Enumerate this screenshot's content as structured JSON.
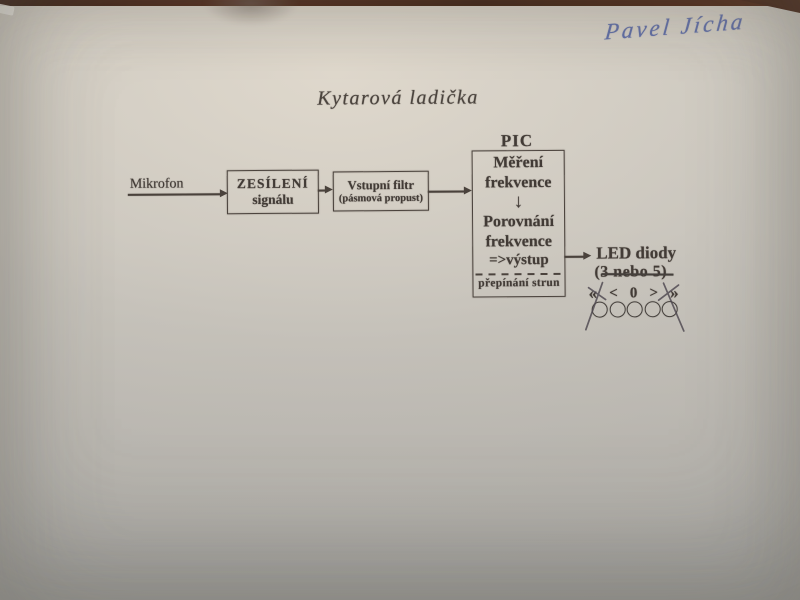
{
  "photo": {
    "paper_color": "#c6c2ba",
    "table_edge_color": "#3f1d0d",
    "print_ink_color": "#423b36",
    "pen_ink_color": "#5f6da5"
  },
  "signature": {
    "text": "Pavel Jícha"
  },
  "title": {
    "text": "Kytarová ladička"
  },
  "diagram": {
    "mikrofon_label": "Mikrofon",
    "amp_box": {
      "line1": "ZESÍLENÍ",
      "line2": "signálu"
    },
    "filter_box": {
      "line1": "Vstupní filtr",
      "line2": "(pásmová propust)"
    },
    "pic": {
      "label": "PIC",
      "measure_line1": "Měření",
      "measure_line2": "frekvence",
      "down_arrow": "↓",
      "compare_line1": "Porovnání",
      "compare_line2": "frekvence",
      "output_line": "=>výstup",
      "bottom_label": "přepínání strun"
    },
    "led": {
      "title": "LED diody",
      "count_note": "(3 nebo 5)",
      "symbols": [
        "«",
        "<",
        "0",
        ">",
        "»"
      ]
    }
  }
}
